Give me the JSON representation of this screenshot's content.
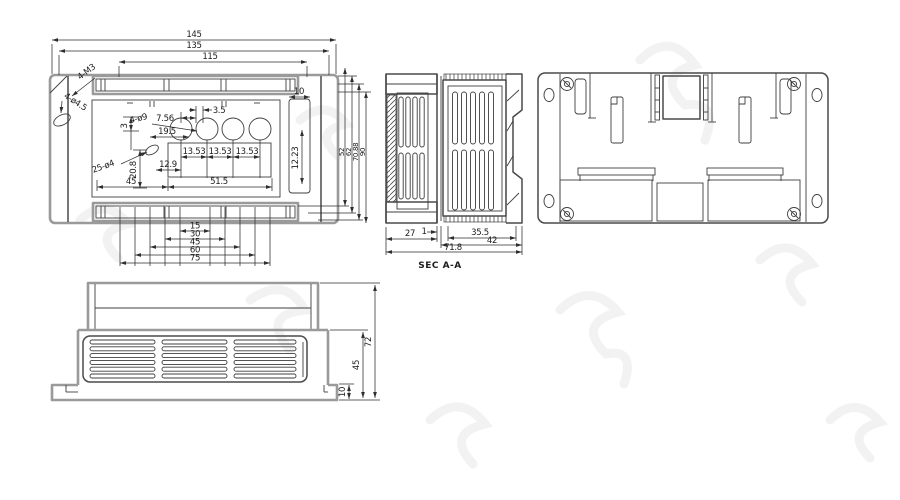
{
  "top_view": {
    "dim_145": "145",
    "dim_135": "135",
    "dim_115": "115",
    "label_4m3": "4-M3",
    "label_4d45": "4-ø4.5",
    "label_4d9": "4-ø9",
    "label_25d4": "25-ø4",
    "dim_756": "7.56",
    "dim_35": "3.5",
    "dim_195": "19.5",
    "dim_3": "3",
    "dim_208": "20.8",
    "dim_1353_1": "13.53",
    "dim_1353_2": "13.53",
    "dim_1353_3": "13.53",
    "dim_129": "12.9",
    "dim_45": "45",
    "dim_515": "51.5",
    "dim_10": "10",
    "dim_1223": "12.23",
    "chain": [
      "15",
      "30",
      "45",
      "60",
      "75"
    ],
    "right_stack": [
      "52",
      "62",
      "70.88",
      "90"
    ]
  },
  "section_view": {
    "dim_27": "27",
    "dim_1": "1",
    "dim_355": "35.5",
    "dim_42": "42",
    "dim_718": "71.8",
    "label": "SEC A-A"
  },
  "front_view": {
    "dim_72": "72",
    "dim_45": "45",
    "dim_10": "10"
  }
}
